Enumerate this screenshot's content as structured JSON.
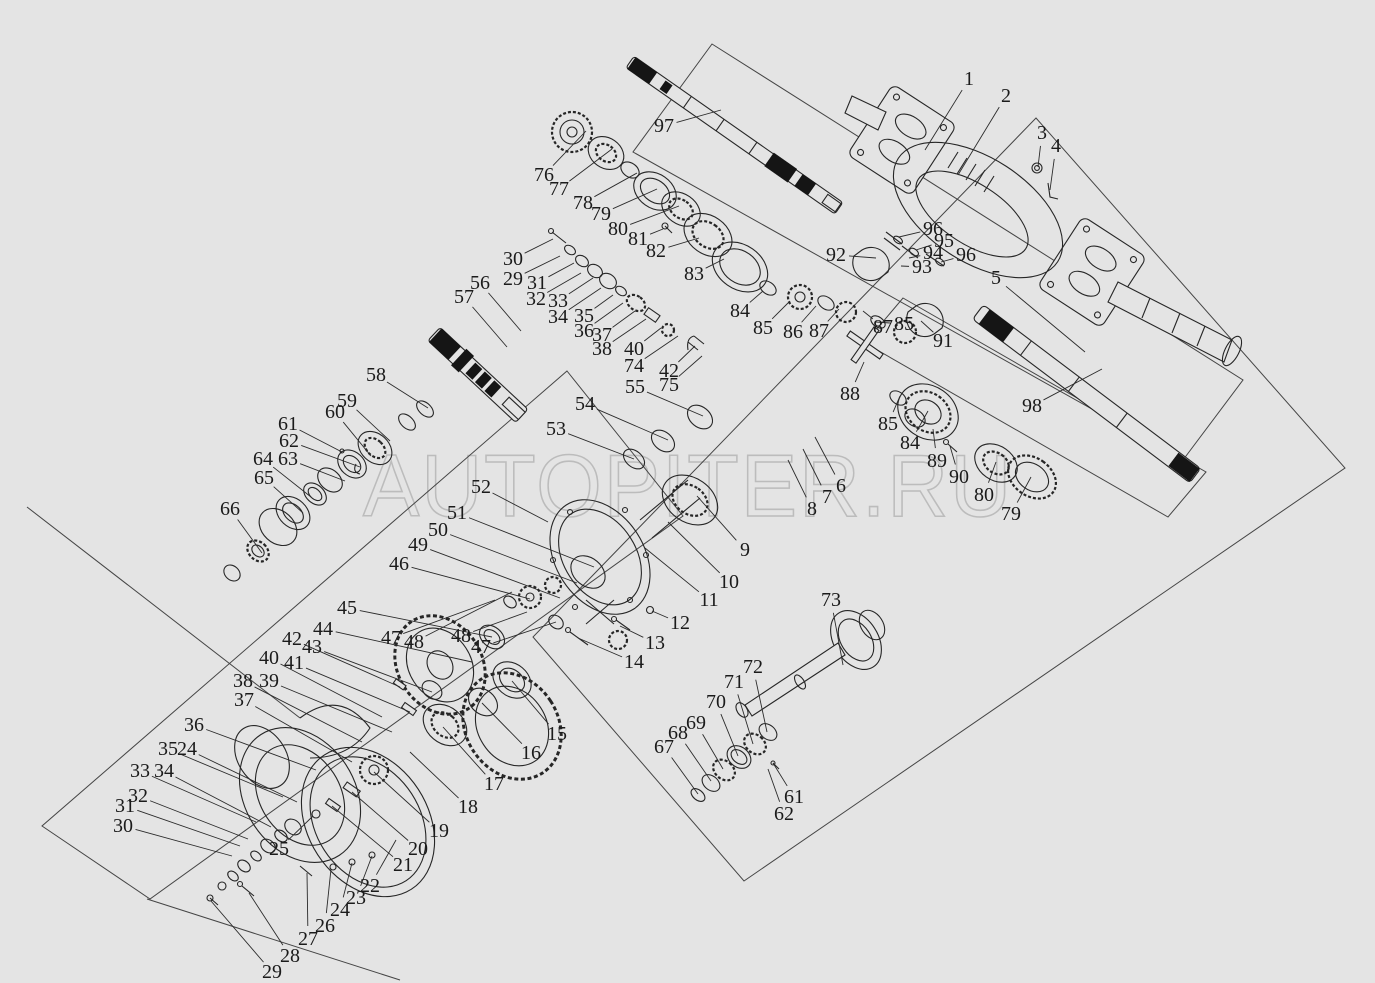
{
  "canvas": {
    "background": "#e4e4e4",
    "line_color": "#262626",
    "frame_color": "#454545",
    "watermark_color": "#bcbcbc"
  },
  "watermark": {
    "text": "AUTOPITER.RU"
  },
  "labels": [
    {
      "n": "1",
      "x": 969,
      "y": 79,
      "lx": 925,
      "ly": 150
    },
    {
      "n": "2",
      "x": 1006,
      "y": 96,
      "lx": 958,
      "ly": 175
    },
    {
      "n": "3",
      "x": 1042,
      "y": 133,
      "lx": 1038,
      "ly": 167
    },
    {
      "n": "4",
      "x": 1056,
      "y": 146,
      "lx": 1050,
      "ly": 190
    },
    {
      "n": "5",
      "x": 996,
      "y": 278,
      "lx": 1085,
      "ly": 352
    },
    {
      "n": "6",
      "x": 841,
      "y": 486,
      "lx": 815,
      "ly": 437
    },
    {
      "n": "7",
      "x": 827,
      "y": 497,
      "lx": 803,
      "ly": 449
    },
    {
      "n": "8",
      "x": 812,
      "y": 509,
      "lx": 788,
      "ly": 460
    },
    {
      "n": "9",
      "x": 745,
      "y": 550,
      "lx": 697,
      "ly": 496
    },
    {
      "n": "10",
      "x": 729,
      "y": 582,
      "lx": 668,
      "ly": 522
    },
    {
      "n": "11",
      "x": 709,
      "y": 600,
      "lx": 645,
      "ly": 548
    },
    {
      "n": "12",
      "x": 680,
      "y": 623,
      "lx": 652,
      "ly": 611
    },
    {
      "n": "13",
      "x": 655,
      "y": 643,
      "lx": 620,
      "ly": 626
    },
    {
      "n": "14",
      "x": 634,
      "y": 662,
      "lx": 578,
      "ly": 638
    },
    {
      "n": "15",
      "x": 557,
      "y": 734,
      "lx": 512,
      "ly": 681
    },
    {
      "n": "16",
      "x": 531,
      "y": 753,
      "lx": 482,
      "ly": 703
    },
    {
      "n": "17",
      "x": 494,
      "y": 784,
      "lx": 443,
      "ly": 727
    },
    {
      "n": "18",
      "x": 468,
      "y": 807,
      "lx": 410,
      "ly": 752
    },
    {
      "n": "19",
      "x": 439,
      "y": 831,
      "lx": 374,
      "ly": 772
    },
    {
      "n": "20",
      "x": 418,
      "y": 849,
      "lx": 352,
      "ly": 792
    },
    {
      "n": "21",
      "x": 403,
      "y": 865,
      "lx": 332,
      "ly": 806
    },
    {
      "n": "22",
      "x": 370,
      "y": 886,
      "lx": 396,
      "ly": 840
    },
    {
      "n": "23",
      "x": 356,
      "y": 898,
      "lx": 372,
      "ly": 856
    },
    {
      "n": "24",
      "x": 340,
      "y": 910,
      "lx": 352,
      "ly": 863
    },
    {
      "n": "25",
      "x": 279,
      "y": 849,
      "lx": 313,
      "ly": 816
    },
    {
      "n": "26",
      "x": 325,
      "y": 926,
      "lx": 331,
      "ly": 869
    },
    {
      "n": "27",
      "x": 308,
      "y": 939,
      "lx": 307,
      "ly": 873
    },
    {
      "n": "28",
      "x": 290,
      "y": 956,
      "lx": 249,
      "ly": 893
    },
    {
      "n": "29",
      "x": 272,
      "y": 972,
      "lx": 211,
      "ly": 901
    },
    {
      "n": "30",
      "x": 123,
      "y": 826,
      "lx": 232,
      "ly": 856
    },
    {
      "n": "31",
      "x": 125,
      "y": 806,
      "lx": 240,
      "ly": 846
    },
    {
      "n": "32",
      "x": 138,
      "y": 796,
      "lx": 248,
      "ly": 839
    },
    {
      "n": "33",
      "x": 140,
      "y": 771,
      "lx": 256,
      "ly": 822
    },
    {
      "n": "34",
      "x": 164,
      "y": 771,
      "lx": 271,
      "ly": 827
    },
    {
      "n": "35",
      "x": 168,
      "y": 749,
      "lx": 283,
      "ly": 797
    },
    {
      "n": "24",
      "x": 187,
      "y": 749,
      "lx": 297,
      "ly": 802
    },
    {
      "n": "36",
      "x": 194,
      "y": 725,
      "lx": 316,
      "ly": 770
    },
    {
      "n": "37",
      "x": 244,
      "y": 700,
      "lx": 352,
      "ly": 762
    },
    {
      "n": "38",
      "x": 243,
      "y": 681,
      "lx": 362,
      "ly": 742
    },
    {
      "n": "39",
      "x": 269,
      "y": 681,
      "lx": 392,
      "ly": 732
    },
    {
      "n": "40",
      "x": 269,
      "y": 658,
      "lx": 382,
      "ly": 717
    },
    {
      "n": "41",
      "x": 294,
      "y": 663,
      "lx": 410,
      "ly": 712
    },
    {
      "n": "42",
      "x": 292,
      "y": 639,
      "lx": 400,
      "ly": 687
    },
    {
      "n": "43",
      "x": 312,
      "y": 647,
      "lx": 432,
      "ly": 692
    },
    {
      "n": "44",
      "x": 323,
      "y": 629,
      "lx": 472,
      "ly": 662
    },
    {
      "n": "45",
      "x": 347,
      "y": 608,
      "lx": 492,
      "ly": 637
    },
    {
      "n": "46",
      "x": 399,
      "y": 564,
      "lx": 530,
      "ly": 599
    },
    {
      "n": "47",
      "x": 391,
      "y": 638,
      "lx": 495,
      "ly": 600
    },
    {
      "n": "48",
      "x": 414,
      "y": 642,
      "lx": 512,
      "ly": 592
    },
    {
      "n": "48",
      "x": 461,
      "y": 636,
      "lx": 527,
      "ly": 612
    },
    {
      "n": "47",
      "x": 481,
      "y": 647,
      "lx": 556,
      "ly": 622
    },
    {
      "n": "49",
      "x": 418,
      "y": 545,
      "lx": 560,
      "ly": 598
    },
    {
      "n": "50",
      "x": 438,
      "y": 530,
      "lx": 577,
      "ly": 583
    },
    {
      "n": "51",
      "x": 457,
      "y": 513,
      "lx": 594,
      "ly": 567
    },
    {
      "n": "52",
      "x": 481,
      "y": 487,
      "lx": 548,
      "ly": 522
    },
    {
      "n": "53",
      "x": 556,
      "y": 429,
      "lx": 634,
      "ly": 459
    },
    {
      "n": "54",
      "x": 585,
      "y": 404,
      "lx": 668,
      "ly": 440
    },
    {
      "n": "55",
      "x": 635,
      "y": 387,
      "lx": 703,
      "ly": 416
    },
    {
      "n": "56",
      "x": 480,
      "y": 283,
      "lx": 521,
      "ly": 331
    },
    {
      "n": "57",
      "x": 464,
      "y": 297,
      "lx": 507,
      "ly": 347
    },
    {
      "n": "58",
      "x": 376,
      "y": 375,
      "lx": 428,
      "ly": 408
    },
    {
      "n": "59",
      "x": 347,
      "y": 401,
      "lx": 390,
      "ly": 441
    },
    {
      "n": "60",
      "x": 335,
      "y": 412,
      "lx": 371,
      "ly": 456
    },
    {
      "n": "61",
      "x": 288,
      "y": 424,
      "lx": 342,
      "ly": 452
    },
    {
      "n": "62",
      "x": 289,
      "y": 441,
      "lx": 360,
      "ly": 467
    },
    {
      "n": "63",
      "x": 288,
      "y": 459,
      "lx": 345,
      "ly": 481
    },
    {
      "n": "64",
      "x": 263,
      "y": 459,
      "lx": 311,
      "ly": 497
    },
    {
      "n": "65",
      "x": 264,
      "y": 478,
      "lx": 303,
      "ly": 513
    },
    {
      "n": "66",
      "x": 230,
      "y": 509,
      "lx": 262,
      "ly": 553
    },
    {
      "n": "67",
      "x": 664,
      "y": 747,
      "lx": 698,
      "ly": 794
    },
    {
      "n": "68",
      "x": 678,
      "y": 733,
      "lx": 711,
      "ly": 781
    },
    {
      "n": "69",
      "x": 696,
      "y": 723,
      "lx": 723,
      "ly": 769
    },
    {
      "n": "70",
      "x": 716,
      "y": 702,
      "lx": 738,
      "ly": 756
    },
    {
      "n": "71",
      "x": 734,
      "y": 682,
      "lx": 753,
      "ly": 744
    },
    {
      "n": "72",
      "x": 753,
      "y": 667,
      "lx": 767,
      "ly": 732
    },
    {
      "n": "73",
      "x": 831,
      "y": 600,
      "lx": 843,
      "ly": 665
    },
    {
      "n": "61",
      "x": 794,
      "y": 797,
      "lx": 773,
      "ly": 763
    },
    {
      "n": "62",
      "x": 784,
      "y": 814,
      "lx": 768,
      "ly": 769
    },
    {
      "n": "74",
      "x": 634,
      "y": 366,
      "lx": 678,
      "ly": 336
    },
    {
      "n": "75",
      "x": 669,
      "y": 385,
      "lx": 702,
      "ly": 356
    },
    {
      "n": "76",
      "x": 544,
      "y": 175,
      "lx": 586,
      "ly": 131
    },
    {
      "n": "77",
      "x": 559,
      "y": 189,
      "lx": 612,
      "ly": 149
    },
    {
      "n": "78",
      "x": 583,
      "y": 203,
      "lx": 637,
      "ly": 173
    },
    {
      "n": "79",
      "x": 601,
      "y": 214,
      "lx": 657,
      "ly": 189
    },
    {
      "n": "80",
      "x": 618,
      "y": 229,
      "lx": 679,
      "ly": 206
    },
    {
      "n": "81",
      "x": 638,
      "y": 239,
      "lx": 663,
      "ly": 229
    },
    {
      "n": "82",
      "x": 656,
      "y": 251,
      "lx": 699,
      "ly": 238
    },
    {
      "n": "83",
      "x": 694,
      "y": 274,
      "lx": 724,
      "ly": 259
    },
    {
      "n": "84",
      "x": 740,
      "y": 311,
      "lx": 763,
      "ly": 291
    },
    {
      "n": "85",
      "x": 763,
      "y": 328,
      "lx": 790,
      "ly": 301
    },
    {
      "n": "86",
      "x": 793,
      "y": 332,
      "lx": 816,
      "ly": 306
    },
    {
      "n": "87",
      "x": 819,
      "y": 331,
      "lx": 839,
      "ly": 309
    },
    {
      "n": "87",
      "x": 883,
      "y": 327,
      "lx": 863,
      "ly": 311
    },
    {
      "n": "85",
      "x": 904,
      "y": 324,
      "lx": 876,
      "ly": 322
    },
    {
      "n": "88",
      "x": 850,
      "y": 394,
      "lx": 864,
      "ly": 362
    },
    {
      "n": "85",
      "x": 888,
      "y": 424,
      "lx": 900,
      "ly": 396
    },
    {
      "n": "84",
      "x": 910,
      "y": 443,
      "lx": 928,
      "ly": 411
    },
    {
      "n": "89",
      "x": 937,
      "y": 461,
      "lx": 933,
      "ly": 429
    },
    {
      "n": "90",
      "x": 959,
      "y": 477,
      "lx": 950,
      "ly": 446
    },
    {
      "n": "80",
      "x": 984,
      "y": 495,
      "lx": 996,
      "ly": 462
    },
    {
      "n": "79",
      "x": 1011,
      "y": 514,
      "lx": 1031,
      "ly": 477
    },
    {
      "n": "91",
      "x": 943,
      "y": 341,
      "lx": 921,
      "ly": 321
    },
    {
      "n": "92",
      "x": 836,
      "y": 255,
      "lx": 876,
      "ly": 258
    },
    {
      "n": "93",
      "x": 922,
      "y": 267,
      "lx": 901,
      "ly": 266
    },
    {
      "n": "94",
      "x": 933,
      "y": 253,
      "lx": 909,
      "ly": 258
    },
    {
      "n": "95",
      "x": 944,
      "y": 241,
      "lx": 916,
      "ly": 250
    },
    {
      "n": "96",
      "x": 933,
      "y": 229,
      "lx": 899,
      "ly": 237
    },
    {
      "n": "96",
      "x": 966,
      "y": 255,
      "lx": 941,
      "ly": 262
    },
    {
      "n": "97",
      "x": 664,
      "y": 126,
      "lx": 721,
      "ly": 110
    },
    {
      "n": "98",
      "x": 1032,
      "y": 406,
      "lx": 1102,
      "ly": 369
    },
    {
      "n": "29",
      "x": 513,
      "y": 279,
      "lx": 560,
      "ly": 256
    },
    {
      "n": "30",
      "x": 513,
      "y": 259,
      "lx": 553,
      "ly": 239
    },
    {
      "n": "31",
      "x": 537,
      "y": 283,
      "lx": 574,
      "ly": 263
    },
    {
      "n": "32",
      "x": 536,
      "y": 299,
      "lx": 581,
      "ly": 273
    },
    {
      "n": "33",
      "x": 558,
      "y": 301,
      "lx": 593,
      "ly": 278
    },
    {
      "n": "34",
      "x": 558,
      "y": 317,
      "lx": 601,
      "ly": 288
    },
    {
      "n": "35",
      "x": 584,
      "y": 316,
      "lx": 613,
      "ly": 295
    },
    {
      "n": "36",
      "x": 584,
      "y": 331,
      "lx": 623,
      "ly": 303
    },
    {
      "n": "37",
      "x": 602,
      "y": 335,
      "lx": 635,
      "ly": 311
    },
    {
      "n": "38",
      "x": 602,
      "y": 349,
      "lx": 646,
      "ly": 319
    },
    {
      "n": "40",
      "x": 634,
      "y": 349,
      "lx": 661,
      "ly": 328
    },
    {
      "n": "42",
      "x": 669,
      "y": 371,
      "lx": 695,
      "ly": 346
    }
  ]
}
